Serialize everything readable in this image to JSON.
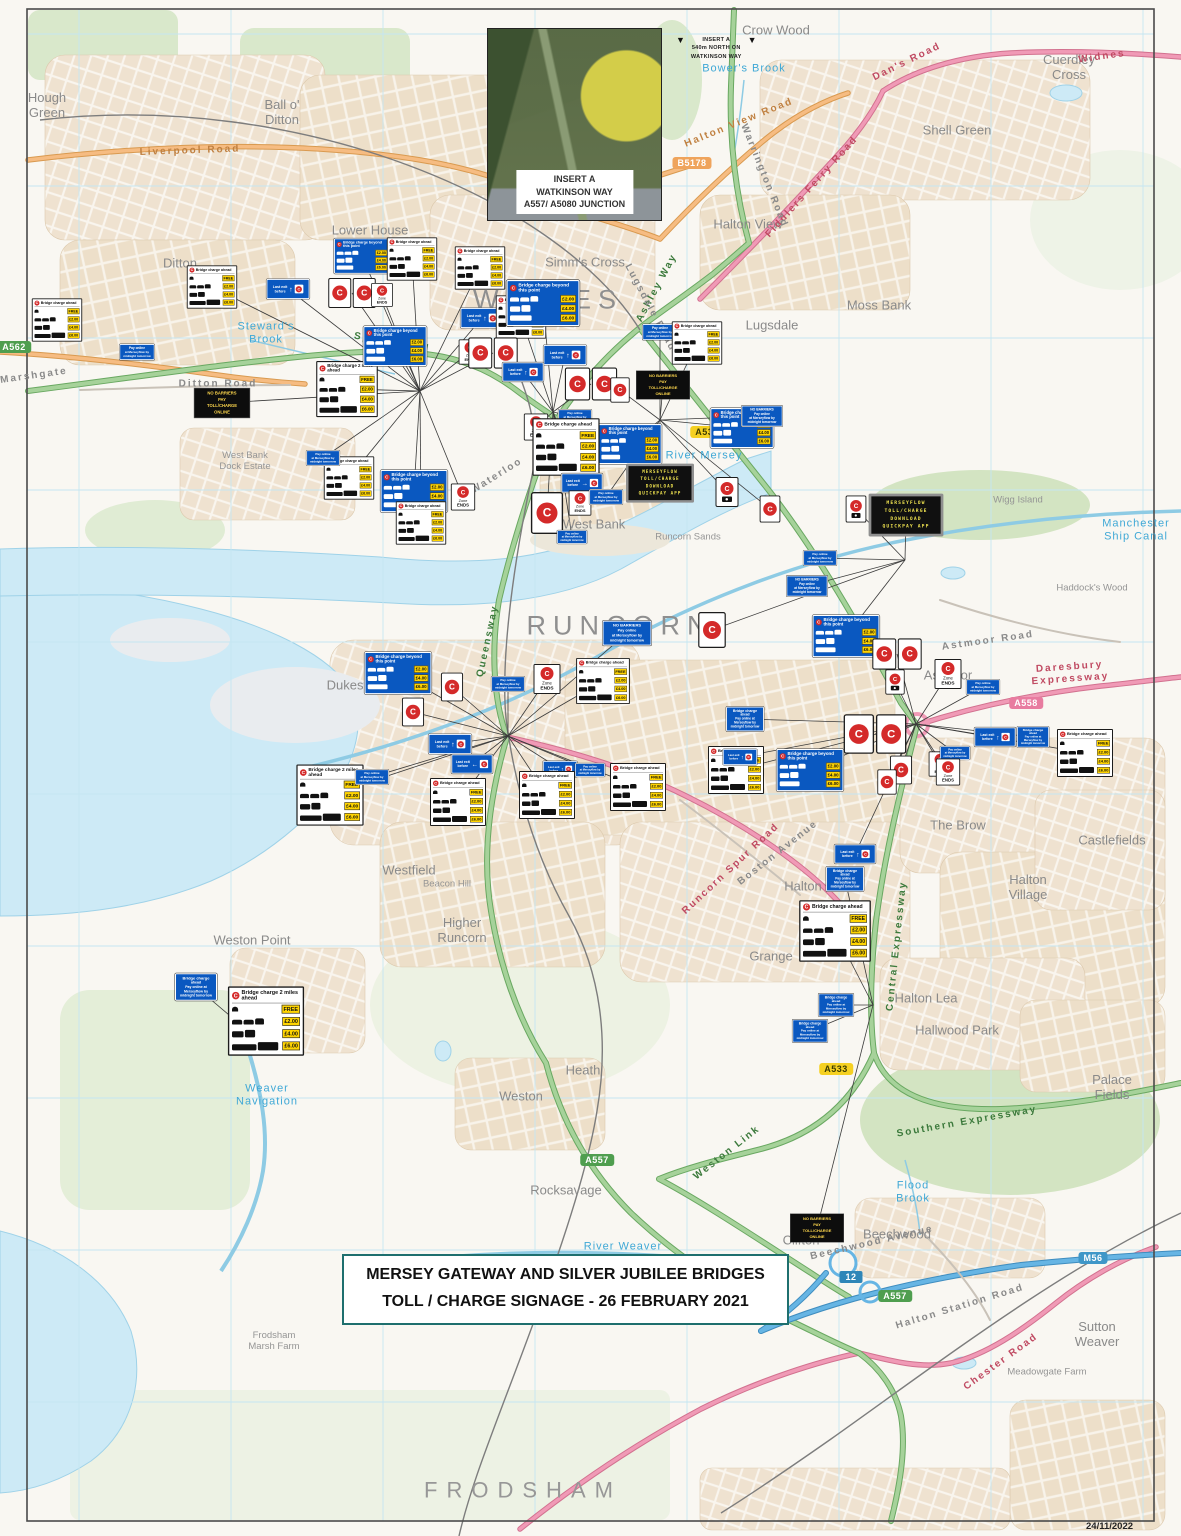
{
  "meta": {
    "date_stamp": "24/11/2022"
  },
  "title_box": {
    "line1": "MERSEY GATEWAY AND SILVER JUBILEE BRIDGES",
    "line2": "TOLL / CHARGE SIGNAGE - 26 FEBRUARY 2021"
  },
  "insert": {
    "label_lines": [
      "INSERT A",
      "WATKINSON WAY",
      "A557/ A5080 JUNCTION"
    ],
    "note_lines": [
      "INSERT A",
      "540m NORTH ON",
      "WATKINSON WAY"
    ],
    "triangle_icon": "▼"
  },
  "colors": {
    "water": "#cdeaf6",
    "urban": "#efe2d0",
    "greenspace": "#d9e8cb",
    "road_green": "#a6d29a",
    "road_pink": "#f09ab6",
    "road_orange": "#f6bc82",
    "motorway_blue": "#66b5e4",
    "sign_blue": "#0a58c0",
    "charge_red": "#d42a2a",
    "price_yellow": "#ffd400",
    "vms_text": "#ede04f",
    "title_border": "#1e6f6e",
    "town_text": "#8f8f8f",
    "water_text": "#3fa8d6"
  },
  "sign_types": {
    "wc": {
      "headers": [
        "Bridge charge ahead",
        "Bridge charge 2 miles ahead",
        "Bridge charge beyond this point"
      ],
      "rows": [
        {
          "veh": [
            "moto"
          ],
          "price": "FREE"
        },
        {
          "veh": [
            "car",
            "car",
            "mpv"
          ],
          "price": "£2.00"
        },
        {
          "veh": [
            "minibus",
            "van"
          ],
          "price": "£4.00"
        },
        {
          "veh": [
            "bus",
            "hgv"
          ],
          "price": "£6.00"
        }
      ]
    },
    "bc": {
      "header": "Bridge charge beyond this point",
      "rows": [
        {
          "veh": [
            "car",
            "car",
            "mpv"
          ],
          "price": "£2.00"
        },
        {
          "veh": [
            "minibus",
            "van"
          ],
          "price": "£4.00"
        },
        {
          "veh": [
            "bus"
          ],
          "price": "£6.00"
        }
      ]
    },
    "po": {
      "lines": [
        "Pay online",
        "at Merseyflow by",
        "midnight tomorrow"
      ]
    },
    "bm": {
      "lines": [
        "Bridge charge",
        "ahead",
        "Pay online at",
        "Merseyflow by",
        "midnight tomorrow"
      ]
    },
    "nb": {
      "lines": [
        "NO BARRIERS",
        "Pay online",
        "at Merseyflow by",
        "midnight tomorrow"
      ]
    },
    "nk": {
      "lines": [
        "NO BARRIERS",
        "PAY",
        "TOLL/CHARGE",
        "ONLINE"
      ]
    },
    "vm": {
      "lines": [
        "MERSEYFLOW",
        "TOLL/CHARGE",
        "DOWNLOAD",
        "QUICKPAY APP"
      ]
    },
    "ze": {
      "zone": "Zone",
      "ends": "ENDS",
      "c": "C"
    },
    "le": {
      "lines": [
        "Last exit",
        "before"
      ],
      "c": "C",
      "arrows": {
        "u": "↑",
        "l": "←",
        "r": "→"
      }
    },
    "cr": {
      "c": "C"
    },
    "ca": {
      "c": "C"
    }
  },
  "signs": [
    {
      "t": "wc",
      "x": 607,
      "y": 65,
      "s": 0.42,
      "nl": 1
    },
    {
      "t": "bc",
      "x": 578,
      "y": 113,
      "s": 0.28,
      "nl": 1
    },
    {
      "t": "wc",
      "x": 212,
      "y": 287,
      "s": 0.45
    },
    {
      "t": "wc",
      "x": 57,
      "y": 320,
      "s": 0.45
    },
    {
      "t": "po",
      "x": 137,
      "y": 352,
      "s": 0.4
    },
    {
      "t": "nk",
      "x": 222,
      "y": 403,
      "s": 0.52
    },
    {
      "t": "wc",
      "x": 347,
      "y": 389,
      "s": 0.55,
      "h": 1
    },
    {
      "t": "bc",
      "x": 362,
      "y": 256,
      "s": 0.46
    },
    {
      "t": "cp",
      "x": 352,
      "y": 293,
      "s": 0.5
    },
    {
      "t": "ze",
      "x": 382,
      "y": 295,
      "s": 0.4
    },
    {
      "t": "wc",
      "x": 412,
      "y": 259,
      "s": 0.45
    },
    {
      "t": "wc",
      "x": 480,
      "y": 268,
      "s": 0.45
    },
    {
      "t": "le",
      "x": 288,
      "y": 289,
      "s": 0.48,
      "d": "u"
    },
    {
      "t": "bc",
      "x": 395,
      "y": 346,
      "s": 0.52
    },
    {
      "t": "le",
      "x": 482,
      "y": 318,
      "s": 0.48,
      "d": "u"
    },
    {
      "t": "wc",
      "x": 521,
      "y": 317,
      "s": 0.45
    },
    {
      "t": "ze",
      "x": 470,
      "y": 352,
      "s": 0.42
    },
    {
      "t": "cp",
      "x": 493,
      "y": 353,
      "s": 0.52
    },
    {
      "t": "bc",
      "x": 543,
      "y": 303,
      "s": 0.6
    },
    {
      "t": "le",
      "x": 565,
      "y": 355,
      "s": 0.48,
      "d": "u"
    },
    {
      "t": "cp",
      "x": 591,
      "y": 384,
      "s": 0.55
    },
    {
      "t": "cr",
      "x": 620,
      "y": 390,
      "s": 0.42
    },
    {
      "t": "nk",
      "x": 663,
      "y": 385,
      "s": 0.5
    },
    {
      "t": "po",
      "x": 660,
      "y": 332,
      "s": 0.4
    },
    {
      "t": "wc",
      "x": 697,
      "y": 343,
      "s": 0.45
    },
    {
      "t": "bc",
      "x": 630,
      "y": 444,
      "s": 0.52
    },
    {
      "t": "bc",
      "x": 742,
      "y": 428,
      "s": 0.52
    },
    {
      "t": "nb",
      "x": 762,
      "y": 416,
      "s": 0.42
    },
    {
      "t": "le",
      "x": 523,
      "y": 372,
      "s": 0.46,
      "d": "u"
    },
    {
      "t": "ze",
      "x": 536,
      "y": 427,
      "s": 0.45
    },
    {
      "t": "po",
      "x": 575,
      "y": 417,
      "s": 0.38
    },
    {
      "t": "wc",
      "x": 566,
      "y": 447,
      "s": 0.6
    },
    {
      "t": "bc",
      "x": 414,
      "y": 491,
      "s": 0.55
    },
    {
      "t": "ze",
      "x": 463,
      "y": 497,
      "s": 0.45
    },
    {
      "t": "wc",
      "x": 349,
      "y": 478,
      "s": 0.45
    },
    {
      "t": "po",
      "x": 323,
      "y": 458,
      "s": 0.38
    },
    {
      "t": "wc",
      "x": 421,
      "y": 523,
      "s": 0.45
    },
    {
      "t": "cr",
      "x": 547,
      "y": 513,
      "s": 0.7
    },
    {
      "t": "le",
      "x": 582,
      "y": 483,
      "s": 0.46,
      "d": "r"
    },
    {
      "t": "ze",
      "x": 580,
      "y": 503,
      "s": 0.42
    },
    {
      "t": "po",
      "x": 606,
      "y": 497,
      "s": 0.38
    },
    {
      "t": "vm",
      "x": 660,
      "y": 483,
      "s": 0.5
    },
    {
      "t": "ca",
      "x": 727,
      "y": 492,
      "s": 0.5
    },
    {
      "t": "vm",
      "x": 906,
      "y": 515,
      "s": 0.55
    },
    {
      "t": "cr",
      "x": 770,
      "y": 509,
      "s": 0.45
    },
    {
      "t": "ca",
      "x": 856,
      "y": 509,
      "s": 0.45
    },
    {
      "t": "po",
      "x": 820,
      "y": 558,
      "s": 0.38
    },
    {
      "t": "nb",
      "x": 807,
      "y": 586,
      "s": 0.42
    },
    {
      "t": "po",
      "x": 572,
      "y": 537,
      "s": 0.34
    },
    {
      "t": "nb",
      "x": 627,
      "y": 633,
      "s": 0.5
    },
    {
      "t": "cr",
      "x": 712,
      "y": 630,
      "s": 0.6
    },
    {
      "t": "bc",
      "x": 398,
      "y": 673,
      "s": 0.55
    },
    {
      "t": "cr",
      "x": 452,
      "y": 687,
      "s": 0.48
    },
    {
      "t": "po",
      "x": 508,
      "y": 684,
      "s": 0.38
    },
    {
      "t": "ze",
      "x": 547,
      "y": 679,
      "s": 0.5
    },
    {
      "t": "wc",
      "x": 603,
      "y": 681,
      "s": 0.48
    },
    {
      "t": "cr",
      "x": 413,
      "y": 712,
      "s": 0.48
    },
    {
      "t": "le",
      "x": 450,
      "y": 744,
      "s": 0.48,
      "d": "u"
    },
    {
      "t": "le",
      "x": 472,
      "y": 764,
      "s": 0.46,
      "d": "l"
    },
    {
      "t": "le",
      "x": 560,
      "y": 769,
      "s": 0.38,
      "d": "u"
    },
    {
      "t": "po",
      "x": 590,
      "y": 770,
      "s": 0.34
    },
    {
      "t": "wc",
      "x": 330,
      "y": 795,
      "s": 0.6,
      "h": 1
    },
    {
      "t": "po",
      "x": 372,
      "y": 777,
      "s": 0.38
    },
    {
      "t": "wc",
      "x": 458,
      "y": 802,
      "s": 0.5
    },
    {
      "t": "wc",
      "x": 547,
      "y": 795,
      "s": 0.5
    },
    {
      "t": "wc",
      "x": 638,
      "y": 787,
      "s": 0.5
    },
    {
      "t": "wc",
      "x": 736,
      "y": 770,
      "s": 0.5
    },
    {
      "t": "bc",
      "x": 810,
      "y": 770,
      "s": 0.55
    },
    {
      "t": "cr",
      "x": 901,
      "y": 770,
      "s": 0.48
    },
    {
      "t": "ze",
      "x": 940,
      "y": 764,
      "s": 0.42
    },
    {
      "t": "bm",
      "x": 745,
      "y": 719,
      "s": 0.45
    },
    {
      "t": "le",
      "x": 740,
      "y": 757,
      "s": 0.38,
      "d": "u"
    },
    {
      "t": "bc",
      "x": 846,
      "y": 636,
      "s": 0.55
    },
    {
      "t": "cp",
      "x": 897,
      "y": 654,
      "s": 0.52
    },
    {
      "t": "ca",
      "x": 895,
      "y": 682,
      "s": 0.42
    },
    {
      "t": "ze",
      "x": 948,
      "y": 674,
      "s": 0.5
    },
    {
      "t": "po",
      "x": 983,
      "y": 687,
      "s": 0.38
    },
    {
      "t": "le",
      "x": 995,
      "y": 737,
      "s": 0.46,
      "d": "u"
    },
    {
      "t": "bm",
      "x": 1033,
      "y": 737,
      "s": 0.38
    },
    {
      "t": "wc",
      "x": 1085,
      "y": 753,
      "s": 0.5
    },
    {
      "t": "po",
      "x": 955,
      "y": 753,
      "s": 0.34
    },
    {
      "t": "ze",
      "x": 948,
      "y": 772,
      "s": 0.45
    },
    {
      "t": "cr",
      "x": 887,
      "y": 782,
      "s": 0.42
    },
    {
      "t": "cp",
      "x": 875,
      "y": 734,
      "s": 0.66
    },
    {
      "t": "le",
      "x": 855,
      "y": 854,
      "s": 0.46,
      "d": "u"
    },
    {
      "t": "bm",
      "x": 845,
      "y": 879,
      "s": 0.45
    },
    {
      "t": "wc",
      "x": 835,
      "y": 931,
      "s": 0.64
    },
    {
      "t": "bm",
      "x": 836,
      "y": 1005,
      "s": 0.42
    },
    {
      "t": "bm",
      "x": 810,
      "y": 1031,
      "s": 0.42
    },
    {
      "t": "bm",
      "x": 196,
      "y": 987,
      "s": 0.5
    },
    {
      "t": "wc",
      "x": 266,
      "y": 1021,
      "s": 0.68,
      "h": 1
    },
    {
      "t": "nk",
      "x": 817,
      "y": 1228,
      "s": 0.5
    }
  ],
  "places": [
    {
      "t": "WIDNES",
      "x": 548,
      "y": 300,
      "c": "tn"
    },
    {
      "t": "RUNCORN",
      "x": 620,
      "y": 626,
      "c": "tn"
    },
    {
      "t": "FRODSHAM",
      "x": 523,
      "y": 1490,
      "c": "tn2"
    },
    {
      "t": "Hough\nGreen",
      "x": 47,
      "y": 106,
      "c": "d"
    },
    {
      "t": "Ball o'\nDitton",
      "x": 282,
      "y": 113,
      "c": "d"
    },
    {
      "t": "Ditton",
      "x": 180,
      "y": 264,
      "c": "d"
    },
    {
      "t": "Lower House",
      "x": 370,
      "y": 231,
      "c": "d"
    },
    {
      "t": "Simm's Cross",
      "x": 585,
      "y": 263,
      "c": "d"
    },
    {
      "t": "Halton View",
      "x": 748,
      "y": 225,
      "c": "d"
    },
    {
      "t": "Lugsdale",
      "x": 772,
      "y": 326,
      "c": "d"
    },
    {
      "t": "Moss Bank",
      "x": 879,
      "y": 306,
      "c": "d"
    },
    {
      "t": "Shell Green",
      "x": 957,
      "y": 131,
      "c": "d"
    },
    {
      "t": "Cuerdley\nCross",
      "x": 1069,
      "y": 68,
      "c": "d"
    },
    {
      "t": "Crow Wood",
      "x": 776,
      "y": 31,
      "c": "d"
    },
    {
      "t": "West Bank",
      "x": 594,
      "y": 525,
      "c": "d"
    },
    {
      "t": "Dukesfield",
      "x": 357,
      "y": 686,
      "c": "d"
    },
    {
      "t": "Astmoor",
      "x": 948,
      "y": 676,
      "c": "d"
    },
    {
      "t": "The Brow",
      "x": 958,
      "y": 826,
      "c": "d"
    },
    {
      "t": "Halton\nVillage",
      "x": 1028,
      "y": 888,
      "c": "d"
    },
    {
      "t": "Castlefields",
      "x": 1112,
      "y": 841,
      "c": "d"
    },
    {
      "t": "Halton",
      "x": 803,
      "y": 887,
      "c": "d"
    },
    {
      "t": "Grange",
      "x": 771,
      "y": 957,
      "c": "d"
    },
    {
      "t": "Higher\nRuncorn",
      "x": 462,
      "y": 931,
      "c": "d"
    },
    {
      "t": "Westfield",
      "x": 409,
      "y": 871,
      "c": "d"
    },
    {
      "t": "Weston Point",
      "x": 252,
      "y": 941,
      "c": "d"
    },
    {
      "t": "Weston",
      "x": 521,
      "y": 1097,
      "c": "d"
    },
    {
      "t": "Heath",
      "x": 583,
      "y": 1071,
      "c": "d"
    },
    {
      "t": "Rocksavage",
      "x": 566,
      "y": 1191,
      "c": "d"
    },
    {
      "t": "Clifton",
      "x": 801,
      "y": 1241,
      "c": "d"
    },
    {
      "t": "Beechwood",
      "x": 897,
      "y": 1235,
      "c": "d"
    },
    {
      "t": "Halton Lea",
      "x": 926,
      "y": 999,
      "c": "d"
    },
    {
      "t": "Hallwood Park",
      "x": 957,
      "y": 1031,
      "c": "d"
    },
    {
      "t": "Palace Fields",
      "x": 1112,
      "y": 1088,
      "c": "d"
    },
    {
      "t": "Sutton Weaver",
      "x": 1097,
      "y": 1335,
      "c": "d"
    },
    {
      "t": "West Bank\nDock Estate",
      "x": 245,
      "y": 462,
      "c": "s"
    },
    {
      "t": "Runcorn Sands",
      "x": 688,
      "y": 538,
      "c": "s"
    },
    {
      "t": "Wigg Island",
      "x": 1018,
      "y": 501,
      "c": "s"
    },
    {
      "t": "Haddock's Wood",
      "x": 1092,
      "y": 589,
      "c": "s"
    },
    {
      "t": "Beacon Hill",
      "x": 447,
      "y": 885,
      "c": "s"
    },
    {
      "t": "Meadowgate Farm",
      "x": 1047,
      "y": 1373,
      "c": "s"
    },
    {
      "t": "Frodsham\nMarsh Farm",
      "x": 274,
      "y": 1342,
      "c": "s"
    },
    {
      "t": "Bower's Brook",
      "x": 744,
      "y": 69,
      "c": "w"
    },
    {
      "t": "Steward's\nBrook",
      "x": 266,
      "y": 333,
      "c": "w"
    },
    {
      "t": "River Mersey",
      "x": 704,
      "y": 456,
      "c": "w"
    },
    {
      "t": "Manchester\nShip Canal",
      "x": 1136,
      "y": 530,
      "c": "w"
    },
    {
      "t": "Weaver\nNavigation",
      "x": 267,
      "y": 1095,
      "c": "w"
    },
    {
      "t": "Flood\nBrook",
      "x": 913,
      "y": 1192,
      "c": "w"
    },
    {
      "t": "River Weaver",
      "x": 623,
      "y": 1247,
      "c": "w"
    },
    {
      "t": "Liverpool Road",
      "x": 190,
      "y": 151,
      "c": "rd",
      "r": -2,
      "k": "o"
    },
    {
      "t": "Halton View Road",
      "x": 739,
      "y": 123,
      "c": "rd",
      "r": -22,
      "k": "o"
    },
    {
      "t": "Speke Road",
      "x": 392,
      "y": 343,
      "c": "rd",
      "r": 10,
      "k": "g"
    },
    {
      "t": "Ashley Way",
      "x": 657,
      "y": 288,
      "c": "rd",
      "r": -62,
      "k": "g"
    },
    {
      "t": "Queensway",
      "x": 488,
      "y": 641,
      "c": "rd",
      "r": -78,
      "k": "g"
    },
    {
      "t": "Central Expressway",
      "x": 897,
      "y": 946,
      "c": "rd",
      "r": -84,
      "k": "g"
    },
    {
      "t": "Southern Expressway",
      "x": 967,
      "y": 1122,
      "c": "rd",
      "r": -10,
      "k": "g"
    },
    {
      "t": "Weston Link",
      "x": 727,
      "y": 1153,
      "c": "rd",
      "r": -38,
      "k": "g"
    },
    {
      "t": "Daresbury Expressway",
      "x": 1070,
      "y": 673,
      "c": "rd",
      "r": -4,
      "k": "p"
    },
    {
      "t": "Fiddlers Ferry Road",
      "x": 812,
      "y": 187,
      "c": "rd",
      "r": -48,
      "k": "p"
    },
    {
      "t": "Dan's Road",
      "x": 907,
      "y": 62,
      "c": "rd",
      "r": -26,
      "k": "p"
    },
    {
      "t": "Widnes",
      "x": 1102,
      "y": 57,
      "c": "rd",
      "r": -8,
      "k": "p"
    },
    {
      "t": "Runcorn Spur Road",
      "x": 731,
      "y": 869,
      "c": "rd",
      "r": -43,
      "k": "p"
    },
    {
      "t": "Chester Road",
      "x": 1001,
      "y": 1362,
      "c": "rd",
      "r": -36,
      "k": "p"
    },
    {
      "t": "Ditton Road",
      "x": 218,
      "y": 384,
      "c": "rd",
      "r": 0,
      "k": "y"
    },
    {
      "t": "Marshgate",
      "x": 34,
      "y": 376,
      "c": "rd",
      "r": -8,
      "k": "y"
    },
    {
      "t": "Waterloo",
      "x": 497,
      "y": 476,
      "c": "rd",
      "r": -32,
      "k": "y"
    },
    {
      "t": "Lugsdale Road",
      "x": 650,
      "y": 308,
      "c": "rd",
      "r": 62,
      "k": "y"
    },
    {
      "t": "Warrington Road",
      "x": 764,
      "y": 176,
      "c": "rd",
      "r": 68,
      "k": "y"
    },
    {
      "t": "Boston Avenue",
      "x": 778,
      "y": 853,
      "c": "rd",
      "r": -38,
      "k": "y"
    },
    {
      "t": "Astmoor Road",
      "x": 988,
      "y": 641,
      "c": "rd",
      "r": -8,
      "k": "y"
    },
    {
      "t": "Halton Station Road",
      "x": 960,
      "y": 1307,
      "c": "rd",
      "r": -17,
      "k": "y"
    },
    {
      "t": "Beechwood Avenue",
      "x": 872,
      "y": 1243,
      "c": "rd",
      "r": -13,
      "k": "y"
    }
  ],
  "shields": [
    {
      "t": "B5178",
      "x": 692,
      "y": 163,
      "k": "b"
    },
    {
      "t": "A533",
      "x": 707,
      "y": 432,
      "k": "y"
    },
    {
      "t": "A533",
      "x": 836,
      "y": 1069,
      "k": "y"
    },
    {
      "t": "A558",
      "x": 1026,
      "y": 703,
      "k": "p"
    },
    {
      "t": "A557",
      "x": 597,
      "y": 1160,
      "k": "g"
    },
    {
      "t": "A557",
      "x": 895,
      "y": 1296,
      "k": "g"
    },
    {
      "t": "M56",
      "x": 1093,
      "y": 1258,
      "k": "m"
    },
    {
      "t": "12",
      "x": 851,
      "y": 1277,
      "k": "j"
    },
    {
      "t": "A562",
      "x": 14,
      "y": 347,
      "k": "g"
    }
  ]
}
